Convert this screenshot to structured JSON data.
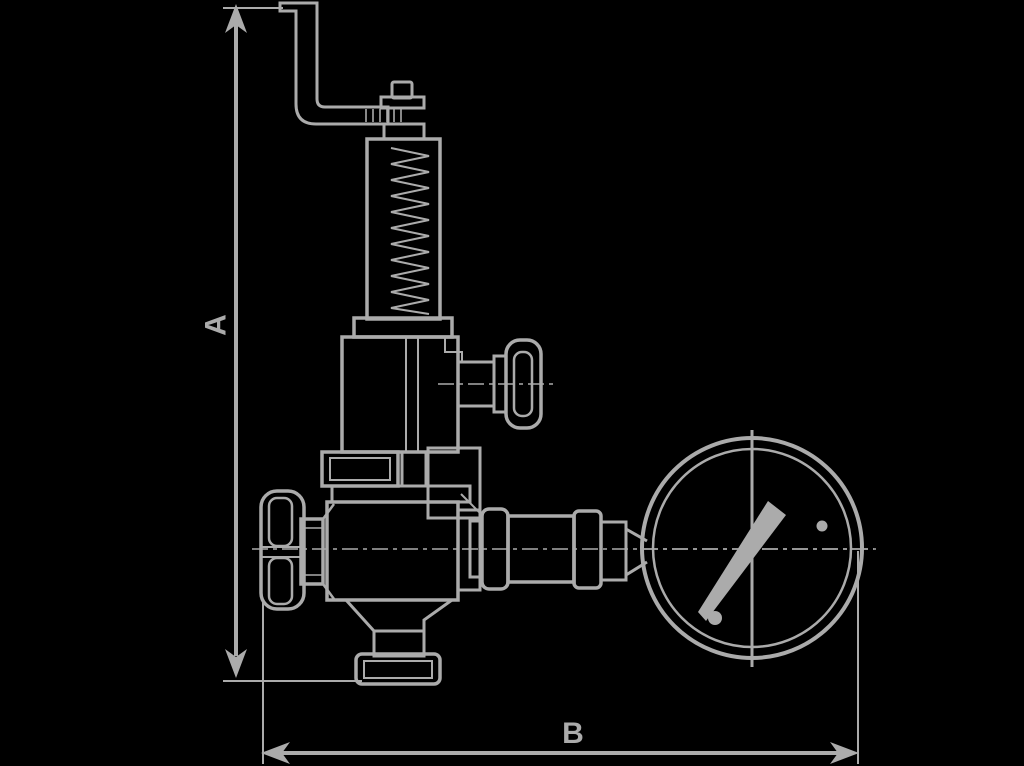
{
  "figure": {
    "background_color": "#000000",
    "line_color": "#ababab",
    "dimension_labels": {
      "vertical": "A",
      "horizontal": "B"
    },
    "components": [
      "adjustment-lever",
      "adjusting-cap",
      "spring-bonnet",
      "spring-coil",
      "valve-upper-body",
      "test-knob",
      "union-nut",
      "valve-lower-body",
      "inlet-handwheel",
      "bottom-outlet-flange",
      "outlet-piping",
      "pressure-gauge",
      "gauge-needle"
    ]
  }
}
